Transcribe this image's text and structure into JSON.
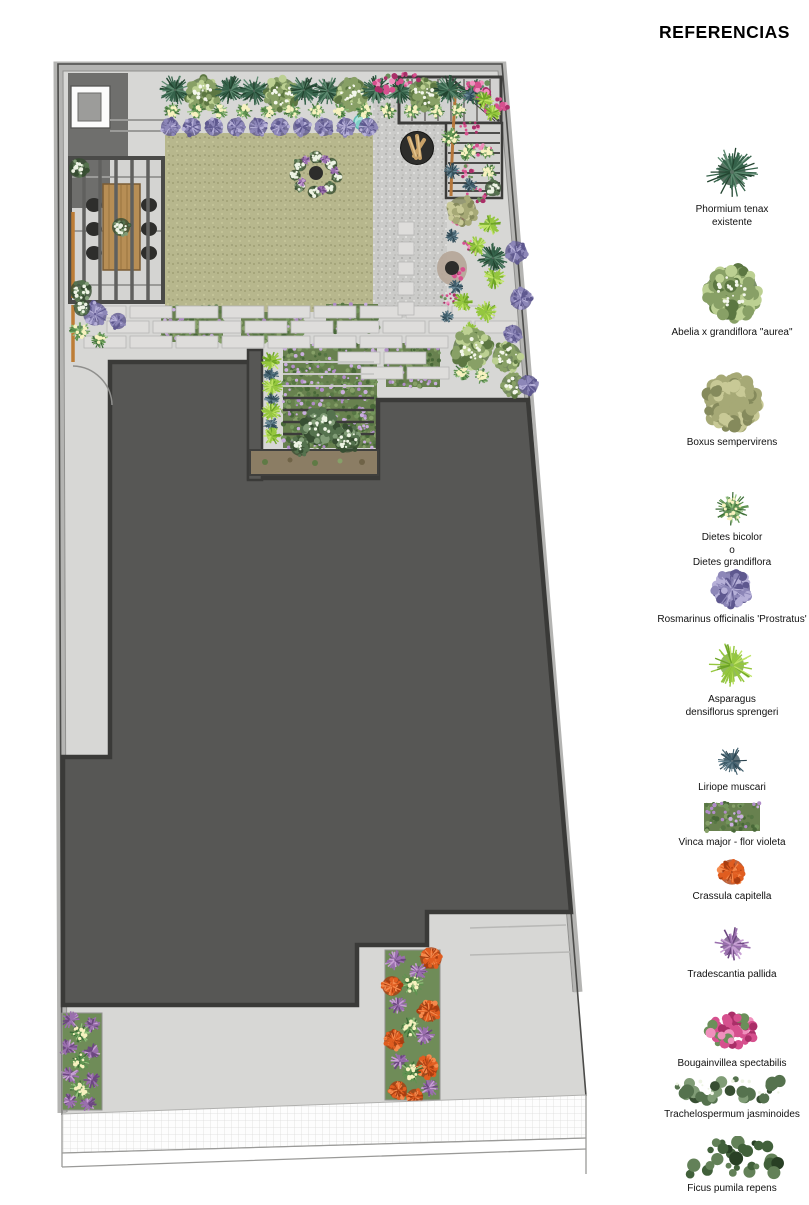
{
  "legend": {
    "title": "REFERENCIAS",
    "items": [
      {
        "id": "phormium",
        "lines": [
          "Phormium tenax",
          "existente"
        ]
      },
      {
        "id": "abelia",
        "lines": [
          "Abelia x grandiflora \"aurea\""
        ]
      },
      {
        "id": "boxus",
        "lines": [
          "Boxus sempervirens"
        ]
      },
      {
        "id": "dietes",
        "lines": [
          "Dietes bicolor",
          "o",
          "Dietes grandiflora"
        ]
      },
      {
        "id": "rosmarinus",
        "lines": [
          "Rosmarinus officinalis 'Prostratus'"
        ]
      },
      {
        "id": "asparagus",
        "lines": [
          "Asparagus",
          "densiflorus sprengeri"
        ]
      },
      {
        "id": "liriope",
        "lines": [
          "Liriope muscari"
        ]
      },
      {
        "id": "vinca",
        "lines": [
          "Vinca major - flor violeta"
        ]
      },
      {
        "id": "crassula",
        "lines": [
          "Crassula capitella"
        ]
      },
      {
        "id": "tradescantia",
        "lines": [
          "Tradescantia pallida"
        ]
      },
      {
        "id": "bougainvillea",
        "lines": [
          "Bougainvillea spectabilis"
        ]
      },
      {
        "id": "trachelospermum",
        "lines": [
          "Trachelospermum jasminoides"
        ]
      },
      {
        "id": "ficus",
        "lines": [
          "Ficus pumila repens"
        ]
      }
    ]
  },
  "colors": {
    "zones": {
      "paving": "#d7d7d5",
      "band": "#b4b4b2",
      "outline": "#4b4b49",
      "lawn": "#b7b78d",
      "gravel": "#cbcbc9",
      "roof": "#575755",
      "roofline": "#3a3a38",
      "utility": "#6f6f6d",
      "wood": "#b78e55",
      "woodwall": "#bd7d36",
      "planter": "#8b7d64",
      "dirt": "#b5a698",
      "firepit": "#2d2d2b",
      "log": "#c9a268",
      "water": "#abe3dc",
      "waterdark": "#62bcb4",
      "bedbase": "#6f8c58",
      "chair": "#2e2e2c",
      "stone": "#dedddb"
    },
    "plants": {
      "phormium": [
        "#35624a",
        "#5d8a70",
        "#22432f"
      ],
      "boxus": [
        "#a6a976",
        "#c8c996",
        "#858a5c"
      ],
      "abelia": [
        "#88a066",
        "#bcd092",
        "#5c7742",
        "#f4f7ec"
      ],
      "dietes": [
        "#5f9350",
        "#92c17c",
        "#3b6b36",
        "#f7f2c0"
      ],
      "rosmarinus": [
        "#8d87b8",
        "#b6b0d8",
        "#5e588f",
        "#6f9460"
      ],
      "asparagus": [
        "#95c73e",
        "#bfe466",
        "#6da426"
      ],
      "liriope": [
        "#415f6d",
        "#6e8c99",
        "#2b4450"
      ],
      "vinca": [
        "#68814f",
        "#b08cc8",
        "#486838"
      ],
      "crassula": [
        "#e05d20",
        "#f58a4d",
        "#a93d10"
      ],
      "tradescantia": [
        "#9a6fae",
        "#c7a0d4",
        "#6c4781"
      ],
      "bougainvillea": [
        "#d6508e",
        "#f090bd",
        "#aa2e68",
        "#6b8f5a"
      ],
      "trachelospermum": [
        "#55724e",
        "#809c76",
        "#374e32",
        "#eef4e5"
      ],
      "ficus": [
        "#41603a",
        "#638158",
        "#283f24"
      ]
    }
  },
  "plan": {
    "plants": [
      [
        "phormium",
        175,
        90,
        17
      ],
      [
        "abelia",
        203,
        94,
        18
      ],
      [
        "phormium",
        230,
        90,
        16
      ],
      [
        "phormium",
        254,
        91,
        16
      ],
      [
        "abelia",
        281,
        94,
        18
      ],
      [
        "phormium",
        304,
        90,
        16
      ],
      [
        "phormium",
        328,
        91,
        16
      ],
      [
        "abelia",
        352,
        94,
        18
      ],
      [
        "phormium",
        376,
        90,
        16
      ],
      [
        "phormium",
        400,
        91,
        15
      ],
      [
        "abelia",
        424,
        94,
        17
      ],
      [
        "phormium",
        449,
        90,
        16
      ],
      [
        "phormium",
        472,
        92,
        15
      ],
      [
        "dietes",
        172,
        111,
        9
      ],
      [
        "dietes",
        196,
        111,
        9
      ],
      [
        "dietes",
        220,
        111,
        9
      ],
      [
        "dietes",
        244,
        111,
        9
      ],
      [
        "dietes",
        268,
        111,
        9
      ],
      [
        "dietes",
        292,
        111,
        9
      ],
      [
        "dietes",
        316,
        111,
        9
      ],
      [
        "dietes",
        340,
        111,
        9
      ],
      [
        "dietes",
        364,
        111,
        9
      ],
      [
        "dietes",
        388,
        111,
        9
      ],
      [
        "dietes",
        412,
        111,
        9
      ],
      [
        "dietes",
        436,
        111,
        9
      ],
      [
        "dietes",
        458,
        111,
        9
      ],
      [
        "rosmarinus",
        170,
        127,
        10
      ],
      [
        "rosmarinus",
        192,
        127,
        10
      ],
      [
        "rosmarinus",
        214,
        127,
        10
      ],
      [
        "rosmarinus",
        236,
        127,
        10
      ],
      [
        "rosmarinus",
        258,
        127,
        10
      ],
      [
        "rosmarinus",
        280,
        127,
        10
      ],
      [
        "rosmarinus",
        302,
        127,
        10
      ],
      [
        "rosmarinus",
        324,
        127,
        10
      ],
      [
        "rosmarinus",
        346,
        127,
        10
      ],
      [
        "rosmarinus",
        368,
        127,
        10
      ],
      [
        "bougainvillea",
        388,
        84,
        13
      ],
      [
        "bougainvillea",
        408,
        79,
        10
      ],
      [
        "bougainvillea",
        478,
        90,
        14
      ],
      [
        "bougainvillea",
        495,
        106,
        12
      ],
      [
        "bougainvillea",
        470,
        128,
        9
      ],
      [
        "bougainvillea",
        484,
        150,
        10
      ],
      [
        "bougainvillea",
        466,
        172,
        9
      ],
      [
        "bougainvillea",
        478,
        195,
        10
      ],
      [
        "bougainvillea",
        461,
        220,
        9
      ],
      [
        "bougainvillea",
        470,
        246,
        9
      ],
      [
        "bougainvillea",
        455,
        273,
        10
      ],
      [
        "bougainvillea",
        449,
        299,
        8
      ],
      [
        "asparagus",
        484,
        100,
        10
      ],
      [
        "liriope",
        470,
        95,
        7
      ],
      [
        "asparagus",
        492,
        113,
        9
      ],
      [
        "dietes",
        487,
        152,
        8
      ],
      [
        "dietes",
        489,
        172,
        9
      ],
      [
        "trachelospermum",
        493,
        188,
        9
      ],
      [
        "dietes",
        450,
        137,
        11
      ],
      [
        "dietes",
        468,
        152,
        10
      ],
      [
        "liriope",
        452,
        171,
        9
      ],
      [
        "liriope",
        470,
        185,
        8
      ],
      [
        "boxus",
        462,
        211,
        16
      ],
      [
        "asparagus",
        490,
        224,
        12
      ],
      [
        "liriope",
        452,
        236,
        8
      ],
      [
        "asparagus",
        477,
        246,
        11
      ],
      [
        "phormium",
        493,
        258,
        16
      ],
      [
        "asparagus",
        494,
        278,
        12
      ],
      [
        "liriope",
        456,
        287,
        8
      ],
      [
        "asparagus",
        463,
        302,
        11
      ],
      [
        "asparagus",
        486,
        312,
        12
      ],
      [
        "liriope",
        447,
        317,
        7
      ],
      [
        "rosmarinus",
        516,
        252,
        12
      ],
      [
        "rosmarinus",
        521,
        299,
        12
      ],
      [
        "rosmarinus",
        513,
        334,
        10
      ],
      [
        "asparagus",
        470,
        331,
        10
      ],
      [
        "abelia",
        472,
        349,
        21
      ],
      [
        "abelia",
        507,
        357,
        16
      ],
      [
        "dietes",
        462,
        372,
        9
      ],
      [
        "dietes",
        482,
        376,
        9
      ],
      [
        "abelia",
        513,
        385,
        13
      ],
      [
        "rosmarinus",
        528,
        385,
        11
      ],
      [
        "rosmarinus",
        95,
        314,
        13
      ],
      [
        "rosmarinus",
        118,
        321,
        9
      ],
      [
        "dietes",
        80,
        331,
        11
      ],
      [
        "dietes",
        100,
        340,
        9
      ],
      [
        "trachelospermum",
        82,
        308,
        9
      ],
      [
        "trachelospermum",
        79,
        168,
        11
      ],
      [
        "trachelospermum",
        81,
        291,
        12
      ],
      [
        "trachelospermum",
        121,
        227,
        10
      ],
      [
        "asparagus",
        271,
        361,
        11
      ],
      [
        "liriope",
        271,
        375,
        8
      ],
      [
        "asparagus",
        272,
        387,
        11
      ],
      [
        "liriope",
        272,
        400,
        8
      ],
      [
        "asparagus",
        271,
        412,
        11
      ],
      [
        "liriope",
        271,
        424,
        8
      ],
      [
        "asparagus",
        272,
        436,
        10
      ],
      [
        "trachelospermum",
        320,
        426,
        19
      ],
      [
        "trachelospermum",
        347,
        439,
        15
      ],
      [
        "trachelospermum",
        300,
        446,
        11
      ],
      [
        "trachelospermum",
        300,
        165,
        7
      ],
      [
        "trachelospermum",
        316,
        157,
        7
      ],
      [
        "trachelospermum",
        331,
        164,
        7
      ],
      [
        "trachelospermum",
        337,
        177,
        6
      ],
      [
        "trachelospermum",
        330,
        188,
        7
      ],
      [
        "trachelospermum",
        314,
        192,
        7
      ],
      [
        "trachelospermum",
        300,
        186,
        6
      ],
      [
        "trachelospermum",
        295,
        175,
        6
      ],
      [
        "tradescantia",
        306,
        160,
        5
      ],
      [
        "tradescantia",
        325,
        159,
        5
      ],
      [
        "tradescantia",
        335,
        171,
        5
      ],
      [
        "tradescantia",
        322,
        190,
        5
      ],
      [
        "tradescantia",
        302,
        182,
        5
      ],
      [
        "tradescantia",
        70,
        1020,
        10
      ],
      [
        "tradescantia",
        92,
        1025,
        9
      ],
      [
        "dietes",
        80,
        1033,
        11
      ],
      [
        "tradescantia",
        68,
        1048,
        10
      ],
      [
        "tradescantia",
        91,
        1052,
        10
      ],
      [
        "dietes",
        80,
        1061,
        11
      ],
      [
        "tradescantia",
        70,
        1075,
        10
      ],
      [
        "tradescantia",
        92,
        1080,
        9
      ],
      [
        "dietes",
        80,
        1089,
        11
      ],
      [
        "tradescantia",
        70,
        1101,
        9
      ],
      [
        "tradescantia",
        88,
        1104,
        9
      ],
      [
        "tradescantia",
        395,
        960,
        11
      ],
      [
        "crassula",
        431,
        958,
        12
      ],
      [
        "tradescantia",
        418,
        971,
        10
      ],
      [
        "dietes",
        412,
        984,
        13
      ],
      [
        "crassula",
        392,
        986,
        11
      ],
      [
        "tradescantia",
        398,
        1005,
        10
      ],
      [
        "crassula",
        429,
        1011,
        12
      ],
      [
        "dietes",
        410,
        1028,
        12
      ],
      [
        "tradescantia",
        424,
        1035,
        11
      ],
      [
        "crassula",
        394,
        1040,
        11
      ],
      [
        "tradescantia",
        400,
        1061,
        10
      ],
      [
        "crassula",
        427,
        1067,
        12
      ],
      [
        "dietes",
        412,
        1072,
        13
      ],
      [
        "tradescantia",
        429,
        1088,
        10
      ],
      [
        "crassula",
        398,
        1090,
        10
      ],
      [
        "crassula",
        415,
        1097,
        9
      ]
    ],
    "vinca_patches": [
      [
        192,
        324,
        62,
        36
      ],
      [
        272,
        327,
        62,
        30
      ],
      [
        352,
        318,
        52,
        28
      ],
      [
        330,
        396,
        94,
        104
      ],
      [
        413,
        365,
        54,
        44
      ]
    ]
  }
}
